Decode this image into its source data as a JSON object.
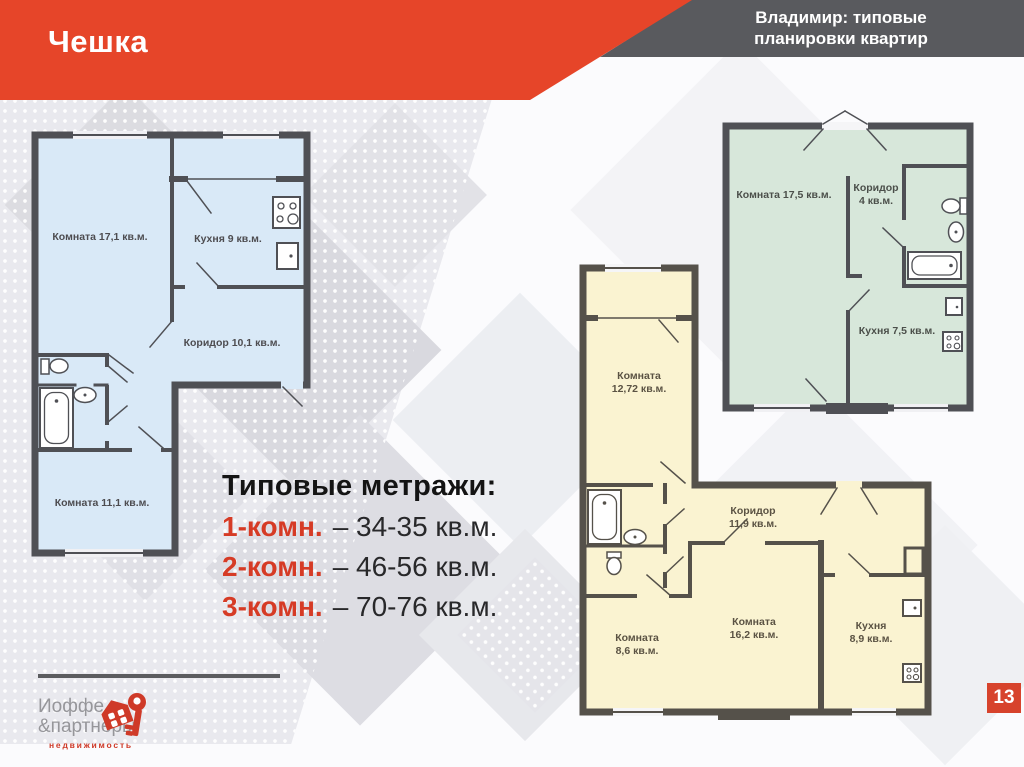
{
  "slide": {
    "title": "Чешка",
    "header_line1": "Владимир: типовые",
    "header_line2": "планировки квартир",
    "page_number": "13"
  },
  "metrics": {
    "heading": "Типовые метражи:",
    "items": [
      {
        "label": "1-комн.",
        "value": "– 34-35 кв.м."
      },
      {
        "label": "2-комн.",
        "value": "– 46-56 кв.м."
      },
      {
        "label": "3-комн.",
        "value": "– 70-76 кв.м."
      }
    ]
  },
  "plans": {
    "blue": {
      "description": "two-room apartment floor plan",
      "rooms": {
        "room1": "Комната 17,1 кв.м.",
        "kitchen": "Кухня 9 кв.м.",
        "corridor": "Коридор 10,1 кв.м.",
        "room2": "Комната 11,1 кв.м."
      }
    },
    "green": {
      "description": "one-room apartment floor plan",
      "rooms": {
        "room": "Комната 17,5 кв.м.",
        "corridor_line1": "Коридор",
        "corridor_line2": "4 кв.м.",
        "kitchen": "Кухня 7,5 кв.м."
      }
    },
    "yellow": {
      "description": "three-room apartment floor plan",
      "rooms": {
        "room1_line1": "Комната",
        "room1_line2": "12,72 кв.м.",
        "corridor_line1": "Коридор",
        "corridor_line2": "11,9 кв.м.",
        "room2_line1": "Комната",
        "room2_line2": "8,6 кв.м.",
        "room3_line1": "Комната",
        "room3_line2": "16,2 кв.м.",
        "kitchen_line1": "Кухня",
        "kitchen_line2": "8,9 кв.м."
      }
    }
  },
  "logo": {
    "line1": "Иоффе",
    "line2": "&партнеры",
    "line3": "недвижимость"
  },
  "colors": {
    "accent_red": "#e64529",
    "banner_gray": "#595a5e",
    "plan_blue_fill": "#d9e9f7",
    "plan_green_fill": "#d7e7da",
    "plan_yellow_fill": "#faf3d1",
    "wall_gray": "#4f5055"
  }
}
